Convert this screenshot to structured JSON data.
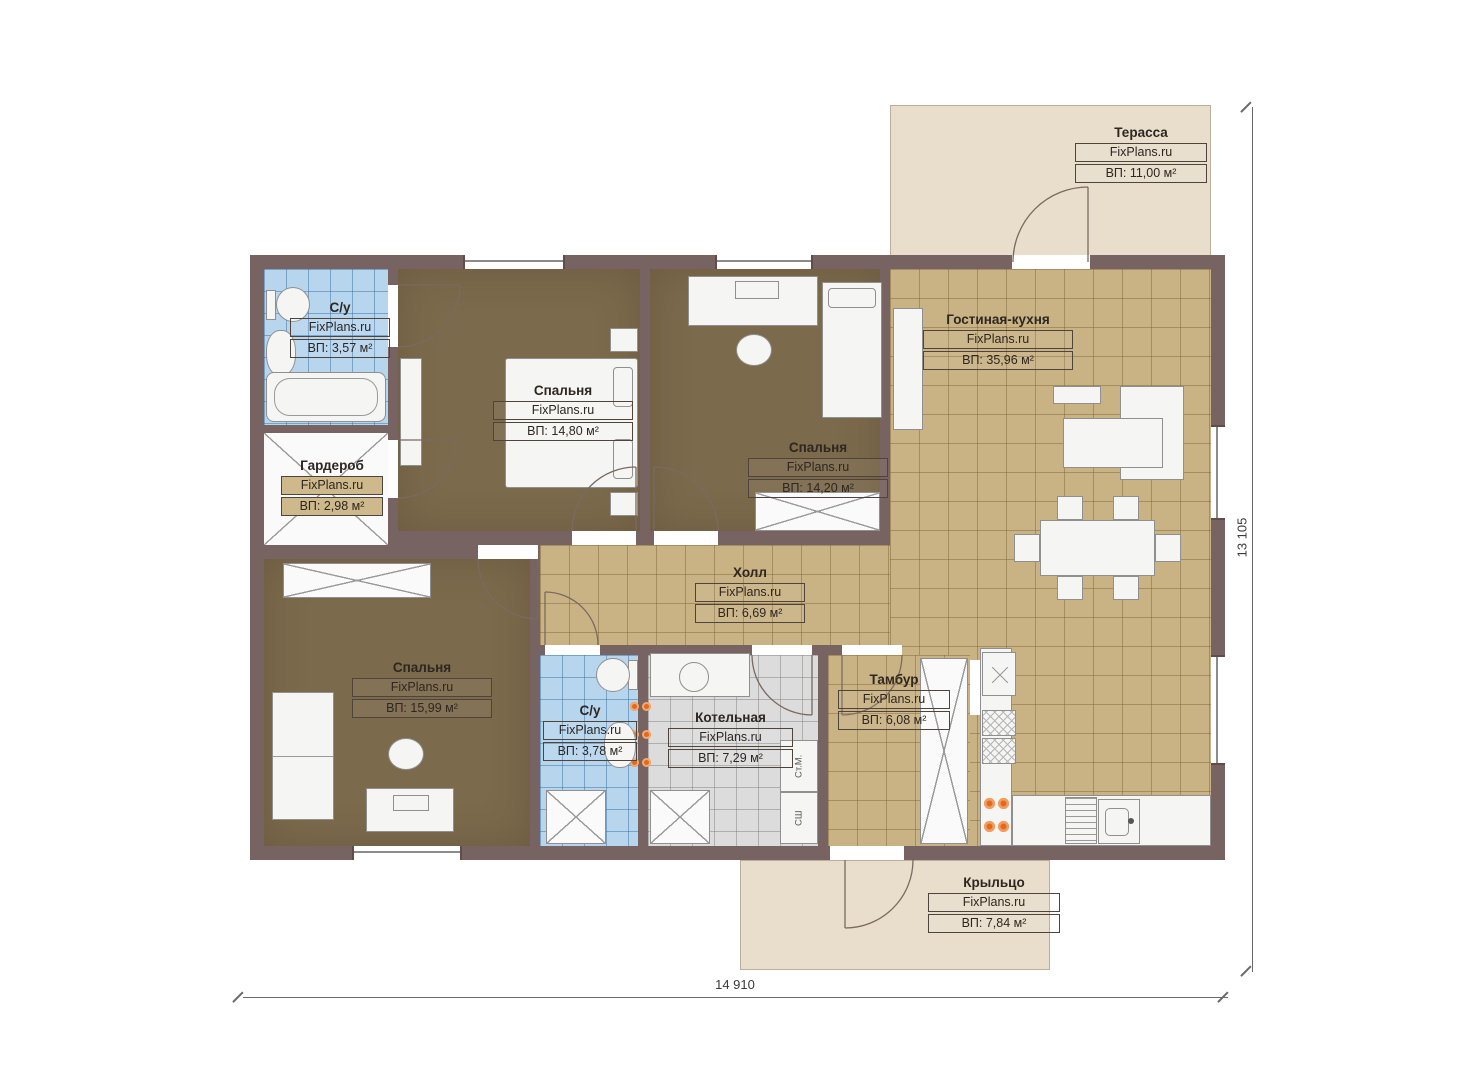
{
  "plan": {
    "brand": "FixPlans.ru",
    "rooms": [
      {
        "id": "terrace",
        "name": "Терасса",
        "brand": "FixPlans.ru",
        "area": "ВП: 11,00 м²"
      },
      {
        "id": "living-kitchen",
        "name": "Гостиная-кухня",
        "brand": "FixPlans.ru",
        "area": "ВП: 35,96 м²"
      },
      {
        "id": "bedroom-1",
        "name": "Спальня",
        "brand": "FixPlans.ru",
        "area": "ВП: 14,80 м²"
      },
      {
        "id": "bedroom-2",
        "name": "Спальня",
        "brand": "FixPlans.ru",
        "area": "ВП: 14,20 м²"
      },
      {
        "id": "bathroom-1",
        "name": "С/у",
        "brand": "FixPlans.ru",
        "area": "ВП: 3,57 м²"
      },
      {
        "id": "wardrobe-room",
        "name": "Гардероб",
        "brand": "FixPlans.ru",
        "area": "ВП: 2,98 м²"
      },
      {
        "id": "hall",
        "name": "Холл",
        "brand": "FixPlans.ru",
        "area": "ВП: 6,69 м²"
      },
      {
        "id": "bedroom-3",
        "name": "Спальня",
        "brand": "FixPlans.ru",
        "area": "ВП: 15,99 м²"
      },
      {
        "id": "bathroom-2",
        "name": "С/у",
        "brand": "FixPlans.ru",
        "area": "ВП: 3,78 м²"
      },
      {
        "id": "boiler-room",
        "name": "Котельная",
        "brand": "FixPlans.ru",
        "area": "ВП: 7,29 м²"
      },
      {
        "id": "tambour",
        "name": "Тамбур",
        "brand": "FixPlans.ru",
        "area": "ВП: 6,08 м²"
      },
      {
        "id": "porch",
        "name": "Крыльцо",
        "brand": "FixPlans.ru",
        "area": "ВП: 7,84 м²"
      }
    ],
    "dimensions": {
      "bottom": "14 910",
      "right": "13 105"
    },
    "appliances": {
      "washing_machine": "Ст.М.",
      "dryer": "СШ"
    },
    "colors": {
      "wall": "#776361",
      "floor_tile_tan": "#c9b385",
      "floor_carpet_brown": "#7c6a4c",
      "floor_tile_blue": "#b7d6ee",
      "floor_tile_gray": "#dcdcdc",
      "outdoor_beige": "#e8decb",
      "stove_accent": "#e4691e"
    }
  }
}
